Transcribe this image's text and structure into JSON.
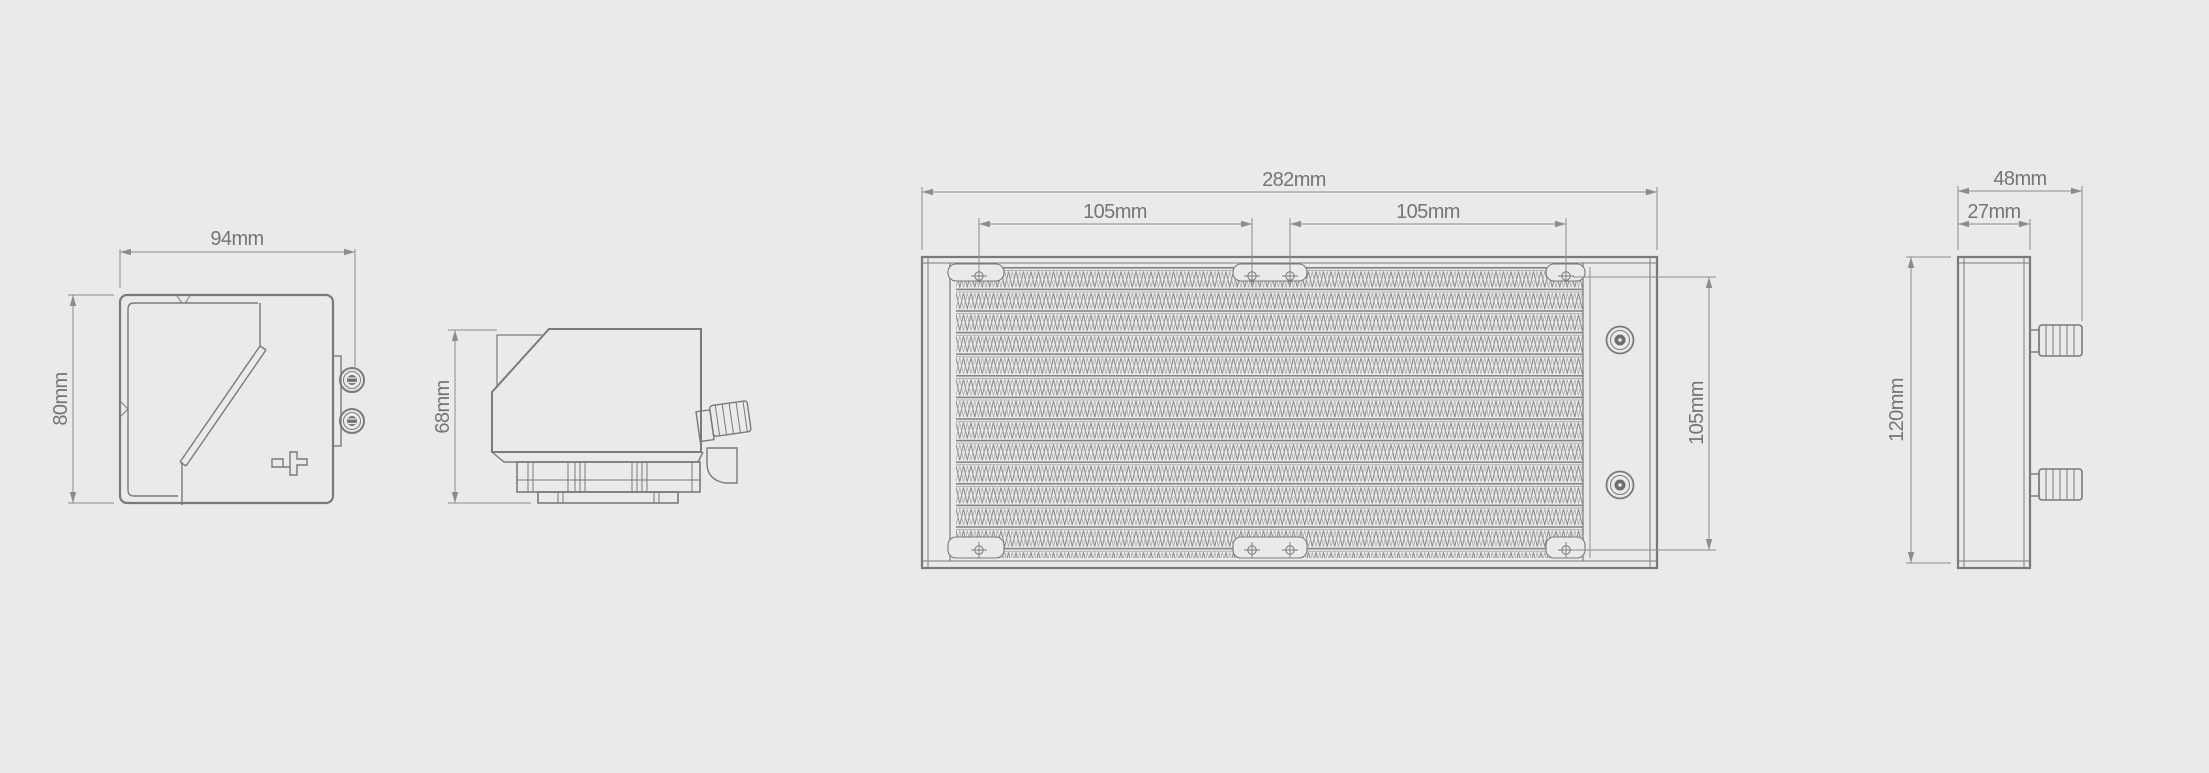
{
  "title": "Dimensions du produit",
  "colors": {
    "background": "#eaeaea",
    "outline": "#7a7a7a",
    "dimension": "#8c8c8c",
    "label": "#757575",
    "title_text": "#3d3d3d"
  },
  "views": {
    "pump_front": {
      "label_width": "94mm",
      "label_height": "80mm"
    },
    "pump_side": {
      "label_height": "68mm"
    },
    "radiator_front": {
      "label_width": "282mm",
      "label_mount_left": "105mm",
      "label_mount_right": "105mm",
      "label_mount_height": "105mm"
    },
    "radiator_side": {
      "label_width": "48mm",
      "label_thickness": "27mm",
      "label_height": "120mm"
    }
  }
}
